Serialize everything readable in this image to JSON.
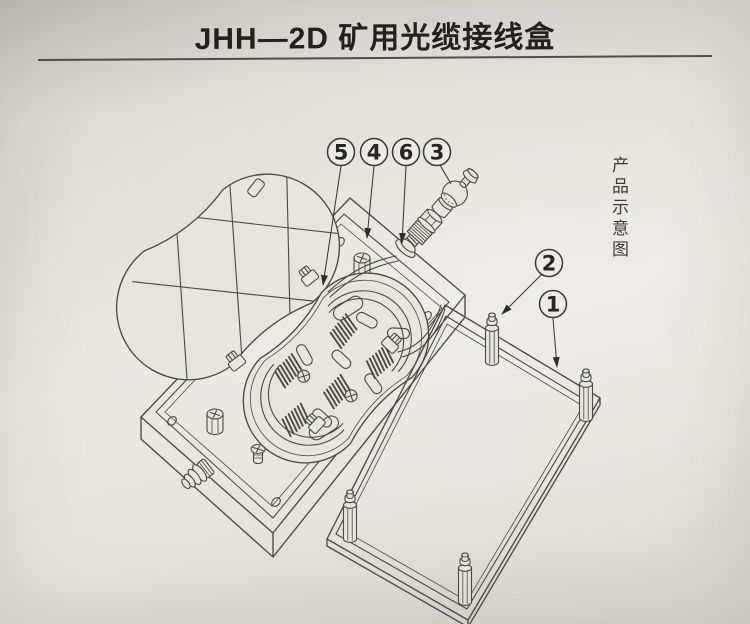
{
  "page": {
    "title": "JHH—2D 矿用光缆接线盒",
    "side_label": "产品示意图"
  },
  "callouts": {
    "c1": "1",
    "c2": "2",
    "c3": "3",
    "c4": "4",
    "c5": "5",
    "c6": "6"
  },
  "colors": {
    "paper": "#e7e5e0",
    "line": "#4b4a45",
    "ink": "#21211f"
  }
}
